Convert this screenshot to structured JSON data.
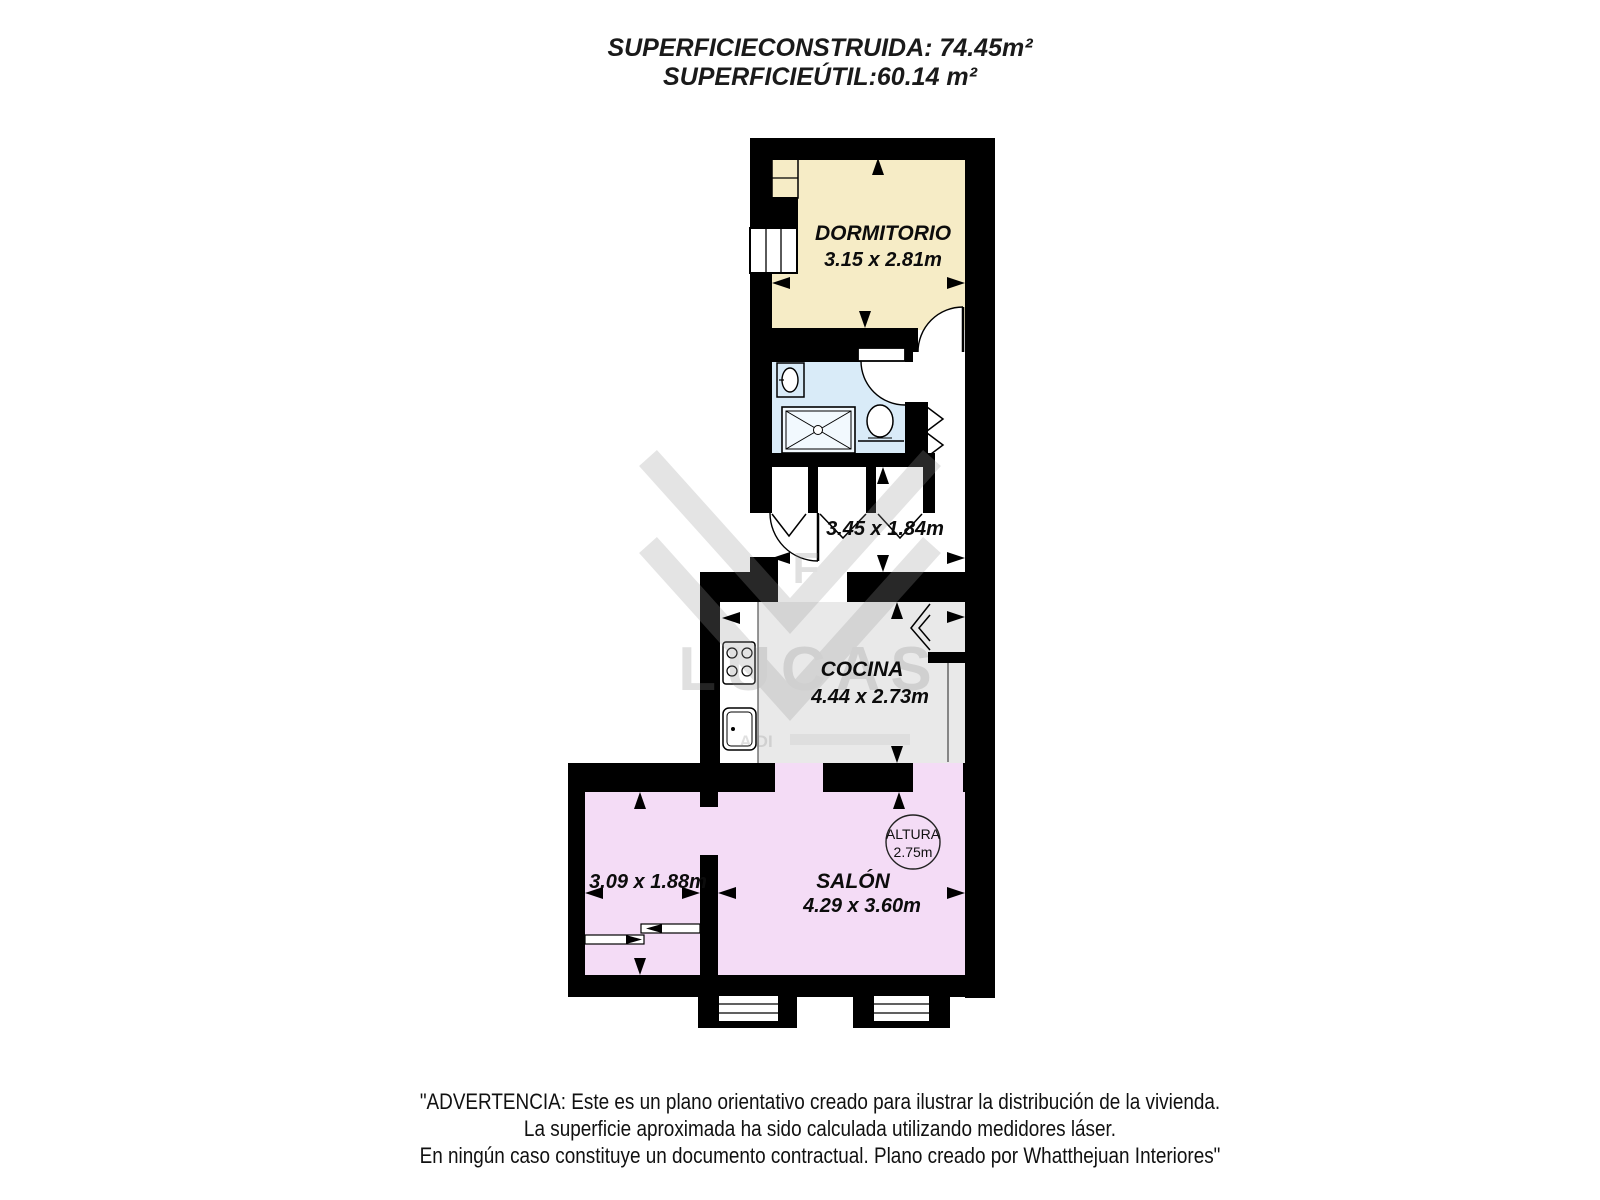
{
  "header": {
    "line1": "SUPERFICIECONSTRUIDA: 74.45m²",
    "line2": "SUPERFICIEÚTIL:60.14 m²"
  },
  "rooms": {
    "dormitorio": {
      "name": "DORMITORIO",
      "dims": "3.15 x 2.81m"
    },
    "pasillo": {
      "dims": "3.45 x 1.84m"
    },
    "cocina": {
      "name": "COCINA",
      "dims": "4.44 x 2.73m"
    },
    "salon": {
      "name": "SALÓN",
      "dims": "4.29 x 3.60m"
    },
    "habitacion2": {
      "dims": "3.09 x 1.88m"
    }
  },
  "altura": {
    "label": "ALTURA",
    "value": "2.75m"
  },
  "watermark": {
    "text": "LUCAS",
    "subtext": "A DI"
  },
  "colors": {
    "wall": "#000000",
    "dormitorio": "#f6ecc6",
    "bathroom": "#d9ebf8",
    "kitchen": "#e9e9e9",
    "salon": "#f4dcf6",
    "shower": "#f2f9fe"
  },
  "footer": {
    "line1": "\"ADVERTENCIA: Este es un plano orientativo creado para ilustrar la distribución de la vivienda.",
    "line2": "La superficie aproximada ha sido calculada utilizando medidores láser.",
    "line3": "En ningún caso constituye un documento contractual. Plano creado por Whatthejuan Interiores\""
  }
}
